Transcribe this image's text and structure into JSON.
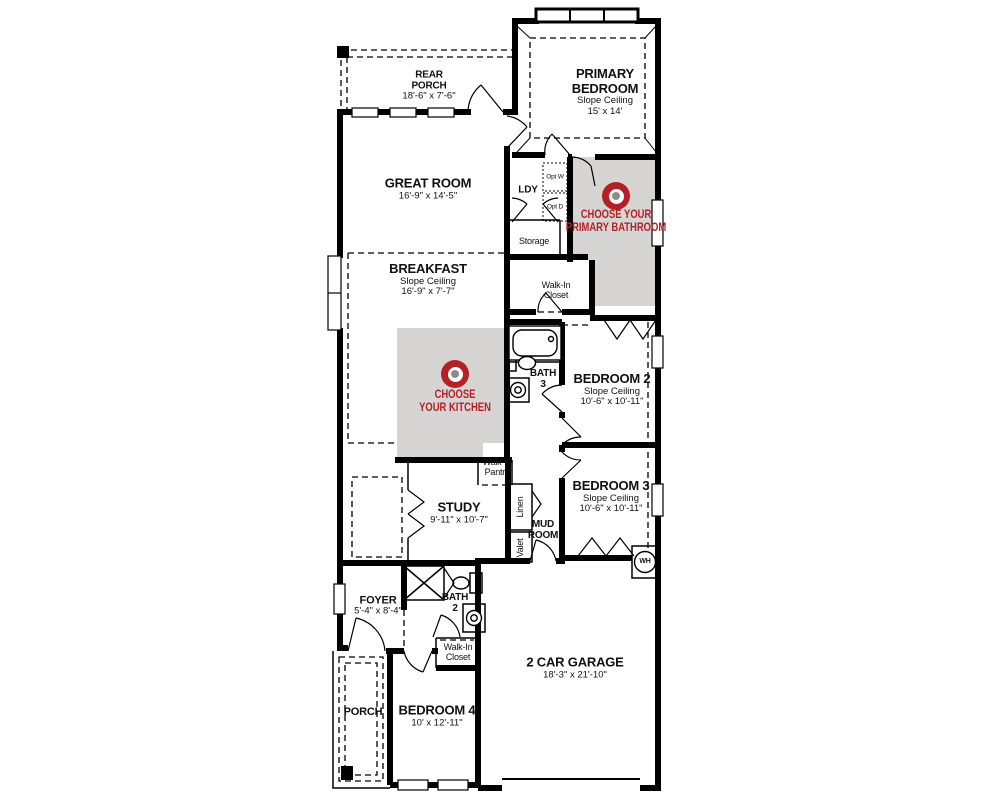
{
  "colors": {
    "accent_red": "#b32025",
    "shade_gray": "#d7d5d3",
    "wall_black": "#000000",
    "target_center_gray": "#8d8d87",
    "background": "#ffffff"
  },
  "hotspots": {
    "primary_bathroom": {
      "line1": "CHOOSE YOUR",
      "line2": "PRIMARY BATHROOM"
    },
    "kitchen": {
      "line1": "CHOOSE",
      "line2": "YOUR KITCHEN"
    }
  },
  "rooms": {
    "rear_porch": {
      "name": "REAR PORCH",
      "dims": "18'-6\" x 7'-6\""
    },
    "primary_bedroom": {
      "name": "PRIMARY BEDROOM",
      "note": "Slope Ceiling",
      "dims": "15' x 14'"
    },
    "great_room": {
      "name": "GREAT ROOM",
      "dims": "16'-9\" x 14'-5\""
    },
    "ldy": {
      "name": "LDY"
    },
    "opt_w": {
      "name": "Opt W"
    },
    "opt_d": {
      "name": "Opt D"
    },
    "storage": {
      "name": "Storage"
    },
    "breakfast": {
      "name": "BREAKFAST",
      "note": "Slope Ceiling",
      "dims": "16'-9\" x 7'-7\""
    },
    "walk_in_closet_primary": {
      "name": "Walk-In Closet"
    },
    "bath_3": {
      "name": "BATH 3"
    },
    "bedroom_2": {
      "name": "BEDROOM 2",
      "note": "Slope Ceiling",
      "dims": "10'-6\" x 10'-11\""
    },
    "bedroom_3": {
      "name": "BEDROOM 3",
      "note": "Slope Ceiling",
      "dims": "10'-6\" x 10'-11\""
    },
    "walk_in_pantry": {
      "name": "Walk-In Pantry"
    },
    "study": {
      "name": "STUDY",
      "dims": "9'-11\" x 10'-7\""
    },
    "linen": {
      "name": "Linen"
    },
    "mud_room": {
      "name": "MUD ROOM"
    },
    "valet": {
      "name": "Valet"
    },
    "water_heater": {
      "name": "WH"
    },
    "foyer": {
      "name": "FOYER",
      "dims": "5'-4\" x 8'-4\""
    },
    "bath_2": {
      "name": "BATH 2"
    },
    "walk_in_closet_bed4": {
      "name": "Walk-In Closet"
    },
    "garage": {
      "name": "2 CAR GARAGE",
      "dims": "18'-3\" x 21'-10\""
    },
    "porch": {
      "name": "PORCH"
    },
    "bedroom_4": {
      "name": "BEDROOM 4",
      "dims": "10' x 12'-11\""
    }
  }
}
